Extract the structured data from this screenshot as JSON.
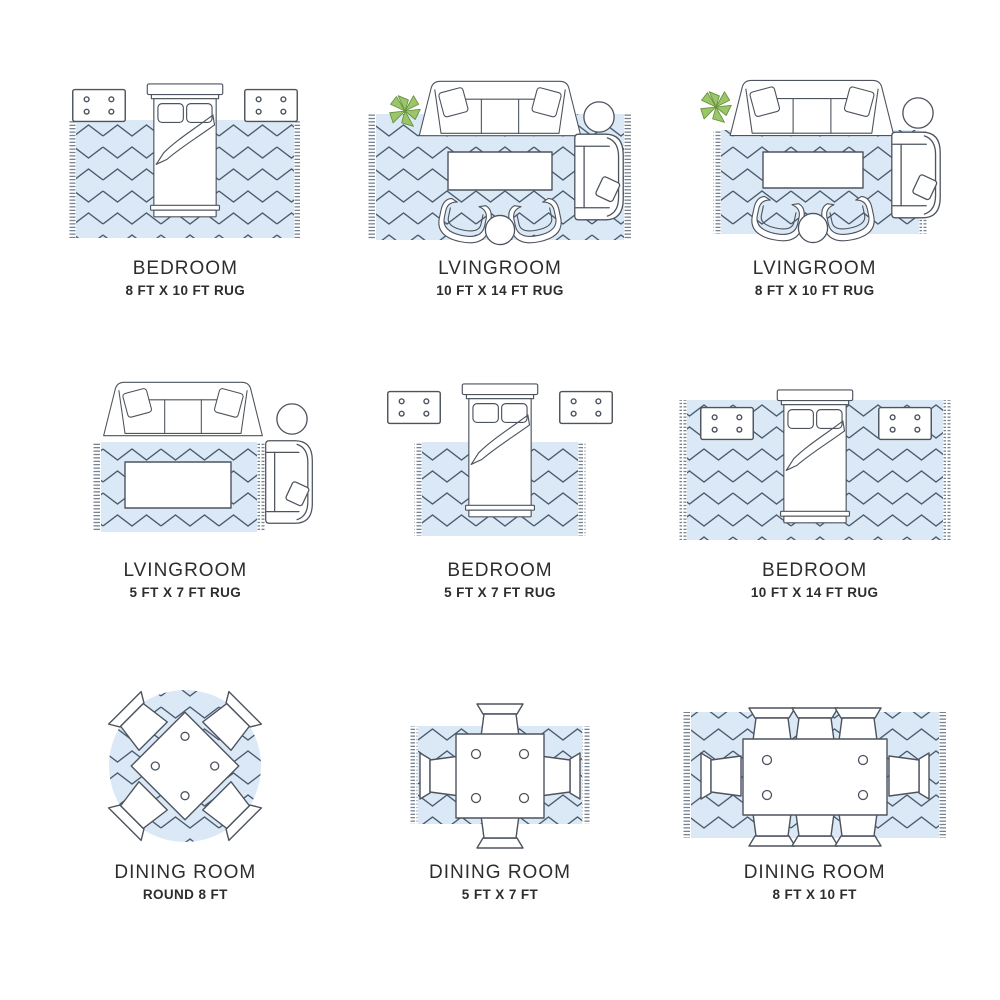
{
  "colors": {
    "rug": "#dbe8f6",
    "line": "#4a5b6e",
    "stroke": "#4d545e",
    "plant": "#9cc468",
    "plant-stroke": "#64913d",
    "text": "#2d2d2d"
  },
  "cells": [
    {
      "room": "BEDROOM",
      "size": "8 FT X 10 FT RUG"
    },
    {
      "room": "LVINGROOM",
      "size": "10 FT X 14 FT RUG"
    },
    {
      "room": "LVINGROOM",
      "size": "8 FT X 10 FT RUG"
    },
    {
      "room": "LVINGROOM",
      "size": "5 FT X 7 FT RUG"
    },
    {
      "room": "BEDROOM",
      "size": "5 FT X 7 FT RUG"
    },
    {
      "room": "BEDROOM",
      "size": "10 FT X 14 FT RUG"
    },
    {
      "room": "DINING ROOM",
      "size": "ROUND 8 FT"
    },
    {
      "room": "DINING ROOM",
      "size": "5 FT X 7 FT"
    },
    {
      "room": "DINING ROOM",
      "size": "8 FT X 10 FT"
    }
  ]
}
